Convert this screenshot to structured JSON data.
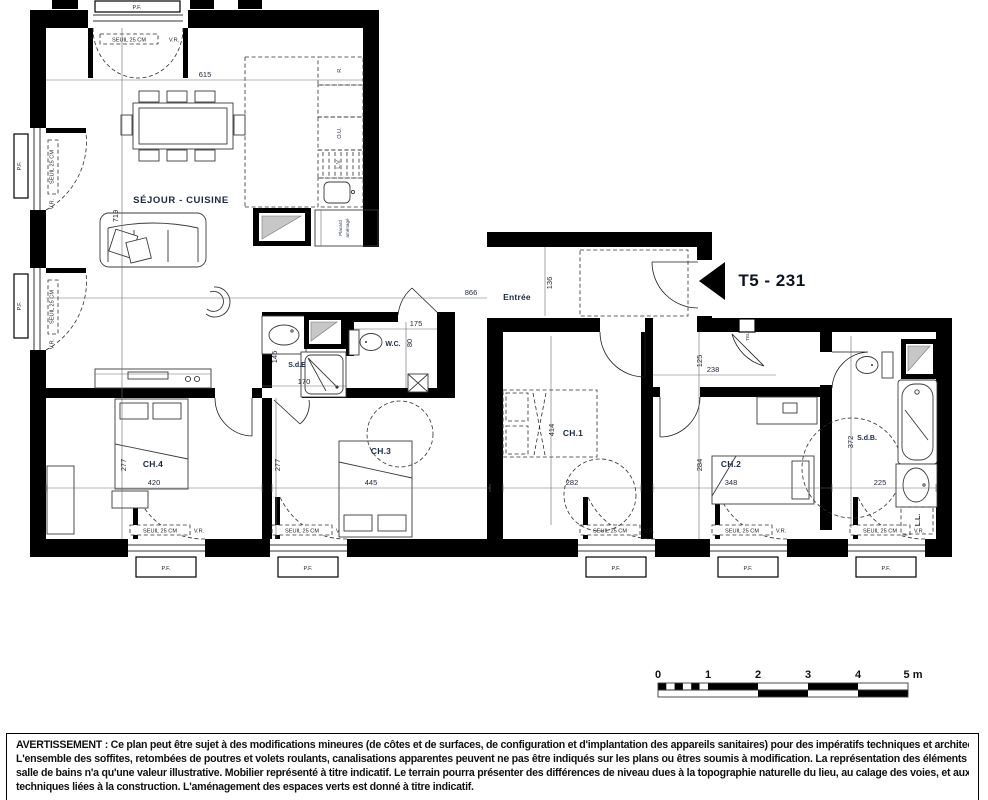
{
  "unit": {
    "label": "T5 - 231"
  },
  "rooms": {
    "sejour": "SÉJOUR - CUISINE",
    "entree": "Entrée",
    "ch1": "CH.1",
    "ch2": "CH.2",
    "ch3": "CH.3",
    "ch4": "CH.4",
    "sde": "S.d.E",
    "wc": "W.C.",
    "sdb": "S.d.B.",
    "tel": "TEL.",
    "ll": "L.L.",
    "placard_line1": "Placard",
    "placard_line2": "aménagé"
  },
  "kitchen": {
    "fridge": "R.",
    "oven": "O.U.",
    "dishwasher": "L.V."
  },
  "window": {
    "pf": "P.F.",
    "seuil": "SEUIL 25 CM",
    "vr": "V.R."
  },
  "dims": {
    "d615": "615",
    "d719": "719",
    "d866": "866",
    "d136": "136",
    "d175": "175",
    "d80": "80",
    "d145": "145",
    "d170": "170",
    "d277a": "277",
    "d420": "420",
    "d277b": "277",
    "d445": "445",
    "d414": "414",
    "d282": "282",
    "d125": "125",
    "d238": "238",
    "d284": "284",
    "d348": "348",
    "d372": "372",
    "d225": "225"
  },
  "scale": {
    "t0": "0",
    "t1": "1",
    "t2": "2",
    "t3": "3",
    "t4": "4",
    "t5": "5 m"
  },
  "disclaimer": {
    "l1": "AVERTISSEMENT : Ce plan peut être sujet à des modifications mineures (de côtes et de surfaces, de configuration et d'implantation des appareils sanitaires) pour des impératifs techniques et architecturaux.",
    "l2": "L'ensemble des soffites, retombées de poutres et volets roulants, canalisations apparentes peuvent ne pas être indiqués sur les plans ou êtres soumis à modification. La représentation des éléments de cuisine et",
    "l3": "salle de bains n'a qu'une valeur illustrative. Mobilier représenté à titre indicatif. Le terrain pourra présenter des différences de niveau dues à la topographie naturelle du lieu, au calage des voies, et aux contraintes",
    "l4": "techniques liées à la construction. L'aménagement des espaces verts est donné à titre indicatif."
  }
}
